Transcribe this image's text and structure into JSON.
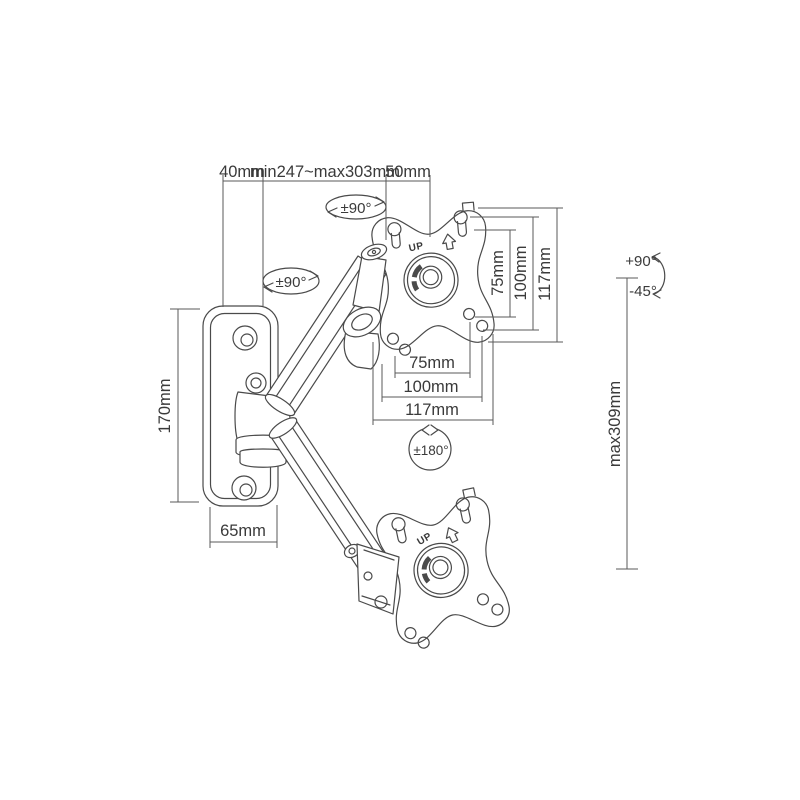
{
  "diagram": {
    "description": "Gas spring monitor wall mount arm technical dimension drawing",
    "line_color": "#4a4a4a",
    "text_color": "#3a3a3a",
    "background_color": "#ffffff",
    "labels": {
      "dim_40": "40mm",
      "dim_reach": "min247~max303mm",
      "dim_50": "50mm",
      "dim_170": "170mm",
      "dim_65": "65mm",
      "dim_v75": "75mm",
      "dim_v100": "100mm",
      "dim_v117": "117mm",
      "dim_h75": "75mm",
      "dim_h100": "100mm",
      "dim_h117": "117mm",
      "dim_max309": "max309mm",
      "rot_swivel_upper": "±90°",
      "rot_swivel_elbow": "±90°",
      "rot_rotation": "±180°",
      "tilt_up": "+90°",
      "tilt_down": "-45°",
      "up_marking_top": "UP",
      "up_marking_bottom": "UP"
    }
  }
}
